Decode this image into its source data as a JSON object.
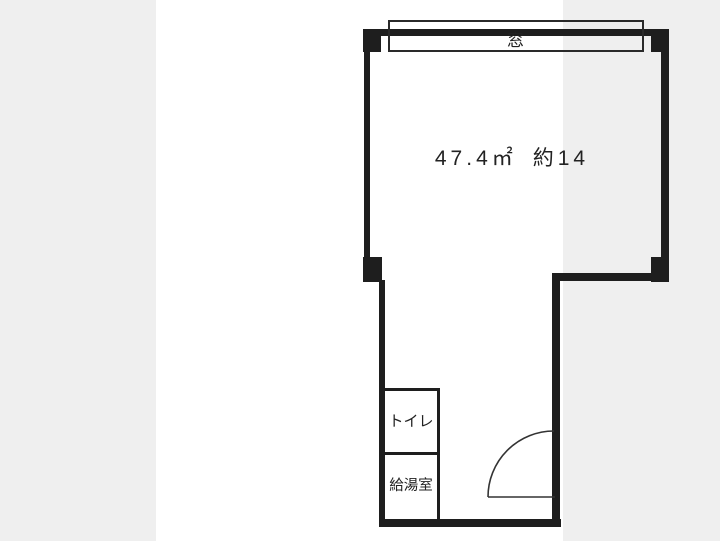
{
  "colors": {
    "page_bg": "#efefef",
    "canvas_bg": "#ffffff",
    "wall": "#1e1e1e",
    "line": "#2a2a2a",
    "text": "#222222"
  },
  "floorplan": {
    "window": {
      "label": "窓"
    },
    "main_room": {
      "area_sqm": "47.4㎡",
      "area_tatami": "約14"
    },
    "toilet": {
      "label": "トイレ"
    },
    "kitchenette": {
      "label": "給湯室"
    }
  }
}
